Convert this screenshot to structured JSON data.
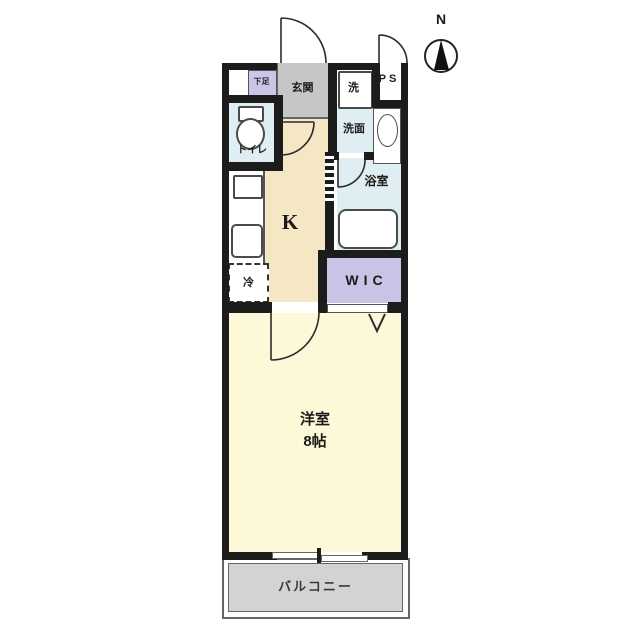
{
  "compass": {
    "north_label": "N"
  },
  "rooms": {
    "entrance": {
      "label": "玄関"
    },
    "shoe_cabinet": {
      "label": "下足"
    },
    "laundry": {
      "label": "洗"
    },
    "pipe_space": {
      "label": "PS"
    },
    "toilet": {
      "label": "トイレ"
    },
    "washroom": {
      "label": "洗面"
    },
    "bathroom": {
      "label": "浴室"
    },
    "kitchen": {
      "label": "K"
    },
    "refrigerator": {
      "label": "冷"
    },
    "walk_in_closet": {
      "label": "WIC"
    },
    "western_room": {
      "label": "洋室",
      "size": "8帖"
    },
    "balcony": {
      "label": "バルコニー"
    }
  },
  "colors": {
    "wall": "#1c1c1c",
    "entrance_floor": "#c6c6c6",
    "water_rooms": "#deeef2",
    "kitchen_floor": "#f5e7c3",
    "western_room_floor": "#fcf8d8",
    "closet": "#c7c4e6",
    "balcony_floor": "#d3d3d3"
  }
}
